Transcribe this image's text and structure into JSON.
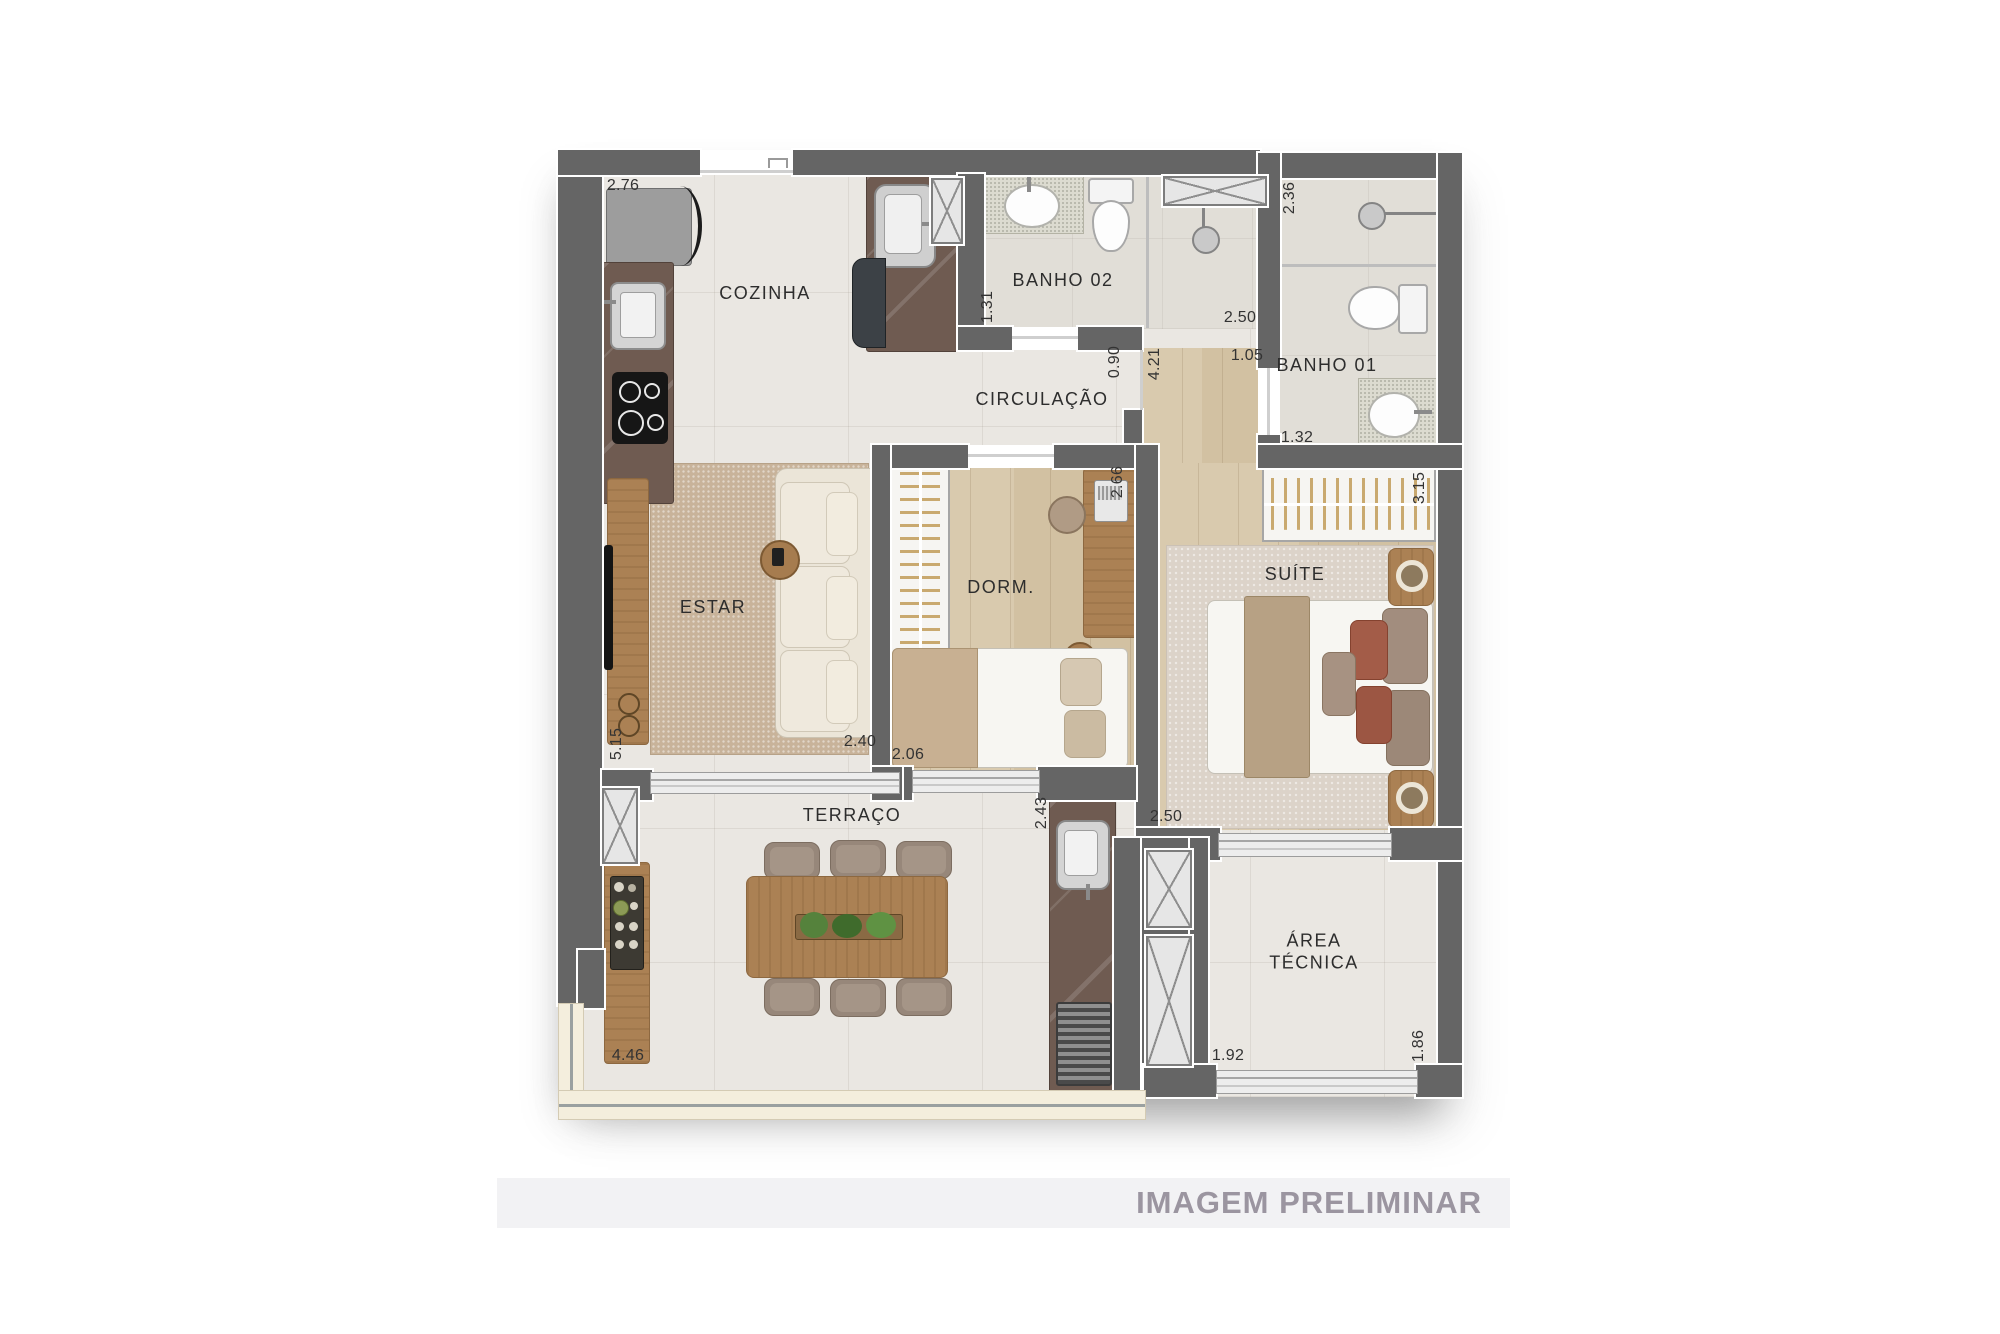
{
  "watermark": "IMAGEM PRELIMINAR",
  "rooms": {
    "cozinha": "COZINHA",
    "banho02": "BANHO 02",
    "banho01": "BANHO 01",
    "circulacao": "CIRCULAÇÃO",
    "estar": "ESTAR",
    "dorm": "DORM.",
    "suite": "SUÍTE",
    "terraco": "TERRAÇO",
    "area_tecnica": "ÁREA TÉCNICA"
  },
  "dimensions": {
    "cozinha_width": "2.76",
    "banho02_depth": "1.31",
    "banho02_shower_width": "2.50",
    "banho01_shower_depth": "2.36",
    "banho01_width": "1.32",
    "circulacao_width": "0.90",
    "hall_length": "4.21",
    "hall_width": "1.05",
    "suite_closet_length": "3.15",
    "dorm_depth": "2.66",
    "estar_width": "2.40",
    "dorm_width": "2.06",
    "estar_depth": "5.15",
    "servico_depth": "2.43",
    "suite_width": "2.50",
    "terraco_width": "4.46",
    "area_tecnica_width": "1.92",
    "area_tecnica_depth": "1.86"
  },
  "colors": {
    "wall": "#656565",
    "floor_tile": "#eae7e2",
    "floor_wood": "#d7c7aa",
    "counter_marble": "#6f5b51",
    "furniture_wood": "#ab8154",
    "watermark_band": "#f2f2f4",
    "watermark_text": "#9b95a0"
  }
}
